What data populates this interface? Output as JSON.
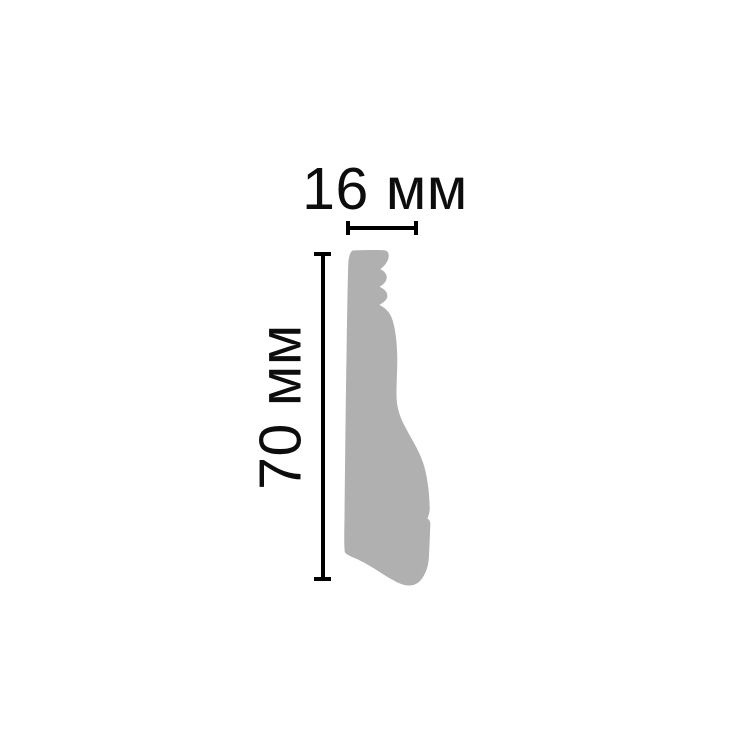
{
  "page": {
    "background": "#ffffff"
  },
  "diagram": {
    "type": "molding-profile-cross-section",
    "width_dimension": {
      "value": 16,
      "unit": "мм",
      "label": "16 мм"
    },
    "height_dimension": {
      "value": 70,
      "unit": "мм",
      "label": "70 мм"
    },
    "colors": {
      "profile_fill": "#b0b0b0",
      "dimension_line": "#000000",
      "label_text": "#0d0d0d"
    }
  }
}
